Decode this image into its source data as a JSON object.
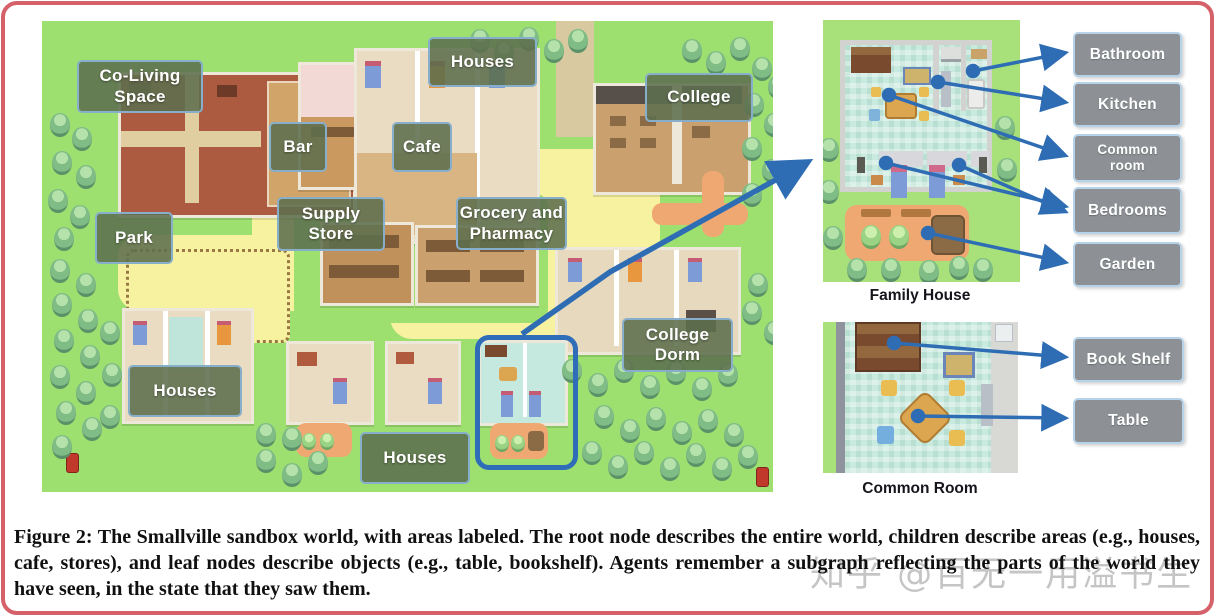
{
  "figure": {
    "caption": "Figure 2: The Smallville sandbox world, with areas labeled. The root node describes the entire world, children describe areas (e.g., houses, cafe, stores), and leaf nodes describe objects (e.g., table, bookshelf). Agents remember a subgraph reflecting the parts of the world they have seen, in the state that they saw them."
  },
  "watermark": {
    "text": "知乎 @百无一用溢书生"
  },
  "map": {
    "labels": {
      "co_living": "Co-Living\nSpace",
      "houses_top": "Houses",
      "college": "College",
      "bar": "Bar",
      "cafe": "Cafe",
      "park": "Park",
      "supply_store": "Supply\nStore",
      "grocery": "Grocery and\nPharmacy",
      "college_dorm": "College\nDorm",
      "houses_bottom_left": "Houses",
      "houses_bottom_mid": "Houses"
    }
  },
  "insets": {
    "family_house": {
      "caption": "Family House",
      "labels": {
        "bathroom": "Bathroom",
        "kitchen": "Kitchen",
        "common_room": "Common\nroom",
        "bedrooms": "Bedrooms",
        "garden": "Garden"
      }
    },
    "common_room": {
      "caption": "Common Room",
      "labels": {
        "book_shelf": "Book Shelf",
        "table": "Table"
      }
    }
  },
  "colors": {
    "arrow_blue": "#2e6db4",
    "highlight_blue": "#2f6db8",
    "frame_pink": "#d5616b",
    "map_label_bg": "#5d6e4d",
    "side_label_bg": "#8d9195"
  }
}
